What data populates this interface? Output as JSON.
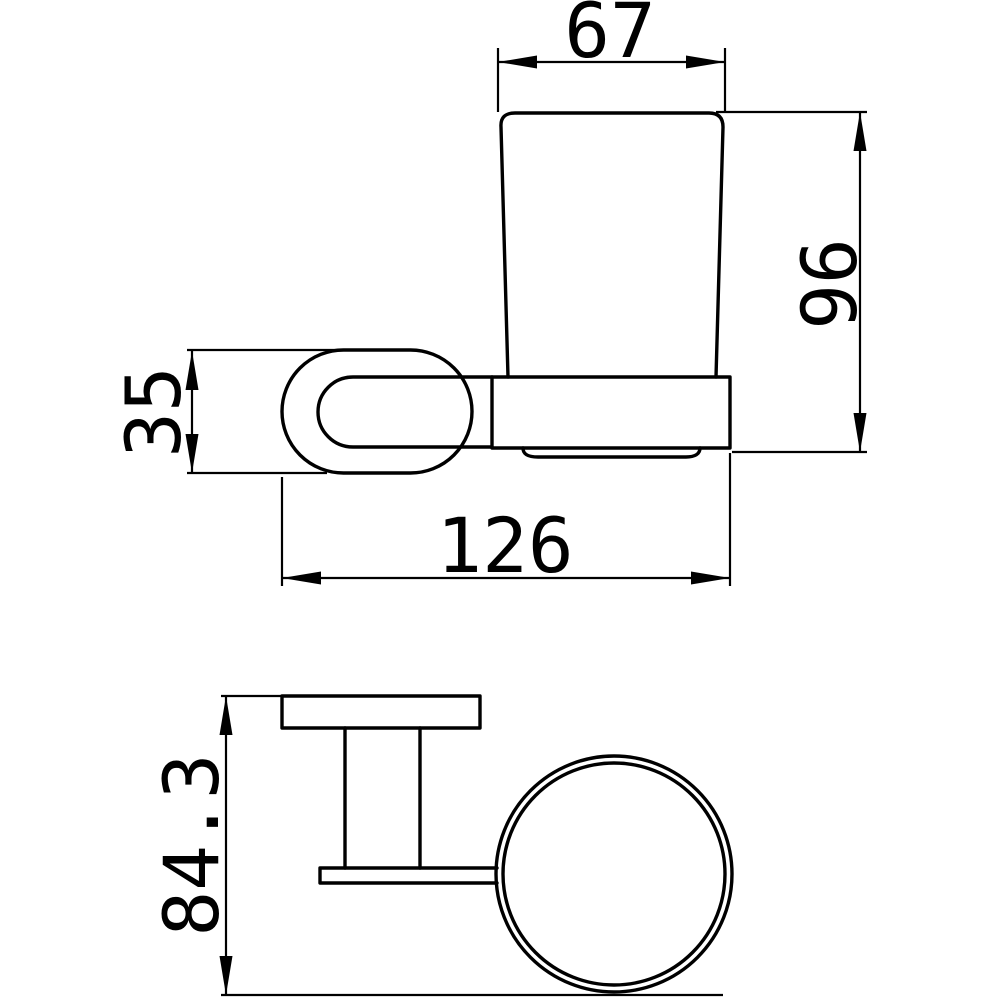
{
  "canvas": {
    "background": "#ffffff",
    "line_color": "#000000"
  },
  "drawing": {
    "dimensions": {
      "cup_top_width": "67",
      "overall_height": "96",
      "bracket_height": "35",
      "overall_depth": "126",
      "plan_depth": "84.3"
    }
  }
}
